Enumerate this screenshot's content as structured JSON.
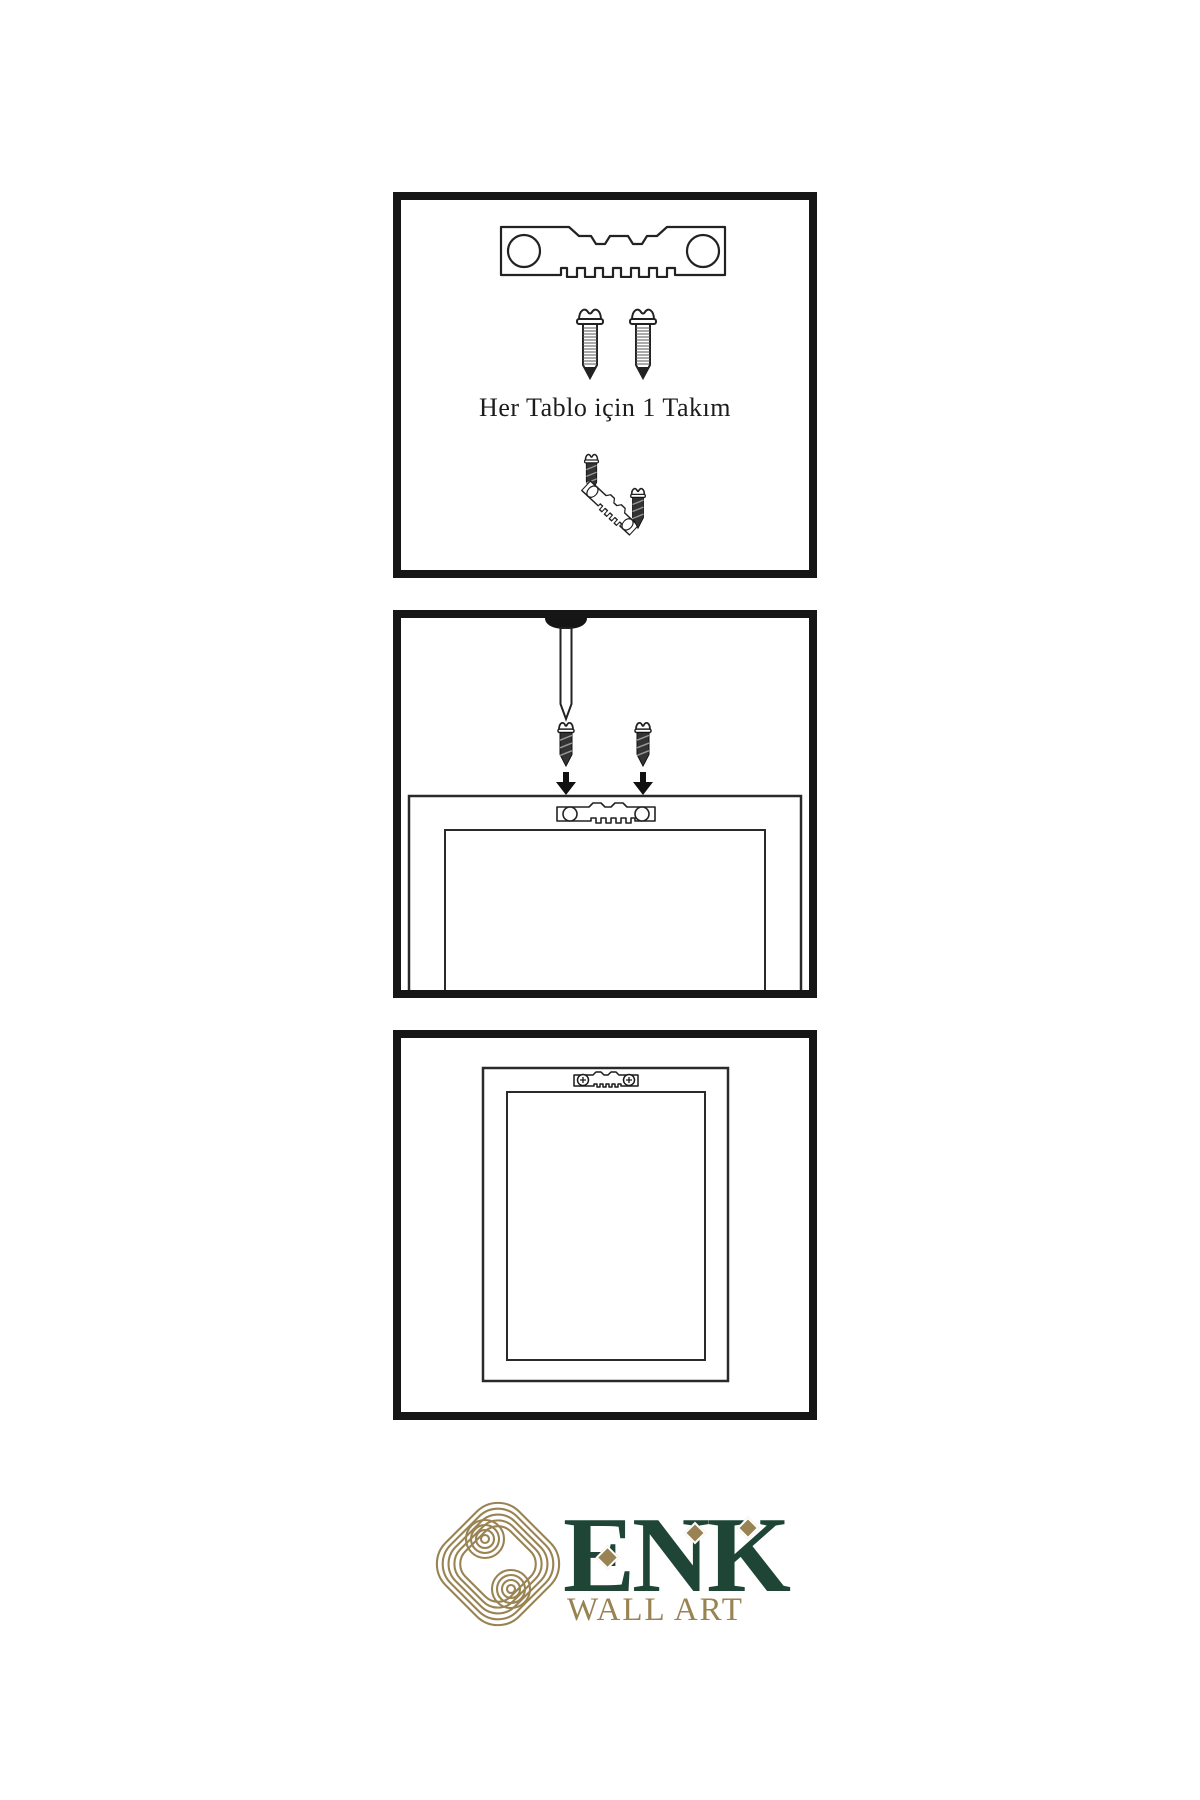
{
  "page": {
    "background": "#ffffff",
    "kind": "wall-art-hanging-instructions"
  },
  "panels": {
    "panel1": {
      "caption": "Her Tablo için 1 Takım",
      "items": [
        "sawtooth-hanger-plate",
        "mounting-screw",
        "mounting-screw",
        "screw-into-angled-hanger",
        "mounting-screw"
      ]
    },
    "panel2": {
      "items": [
        "wall-nail",
        "dark-screw",
        "dark-screw",
        "arrow-down",
        "arrow-down",
        "frame-back-with-sawtooth-hanger"
      ]
    },
    "panel3": {
      "items": [
        "frame-back-with-attached-hanger"
      ]
    }
  },
  "brand": {
    "name": "ENK",
    "tagline": "WALL ART",
    "logo_icon": "interlocked-knot-icon",
    "colors": {
      "green": "#1e4536",
      "gold": "#9a8352",
      "line": "#222222",
      "border": "#161616"
    }
  }
}
